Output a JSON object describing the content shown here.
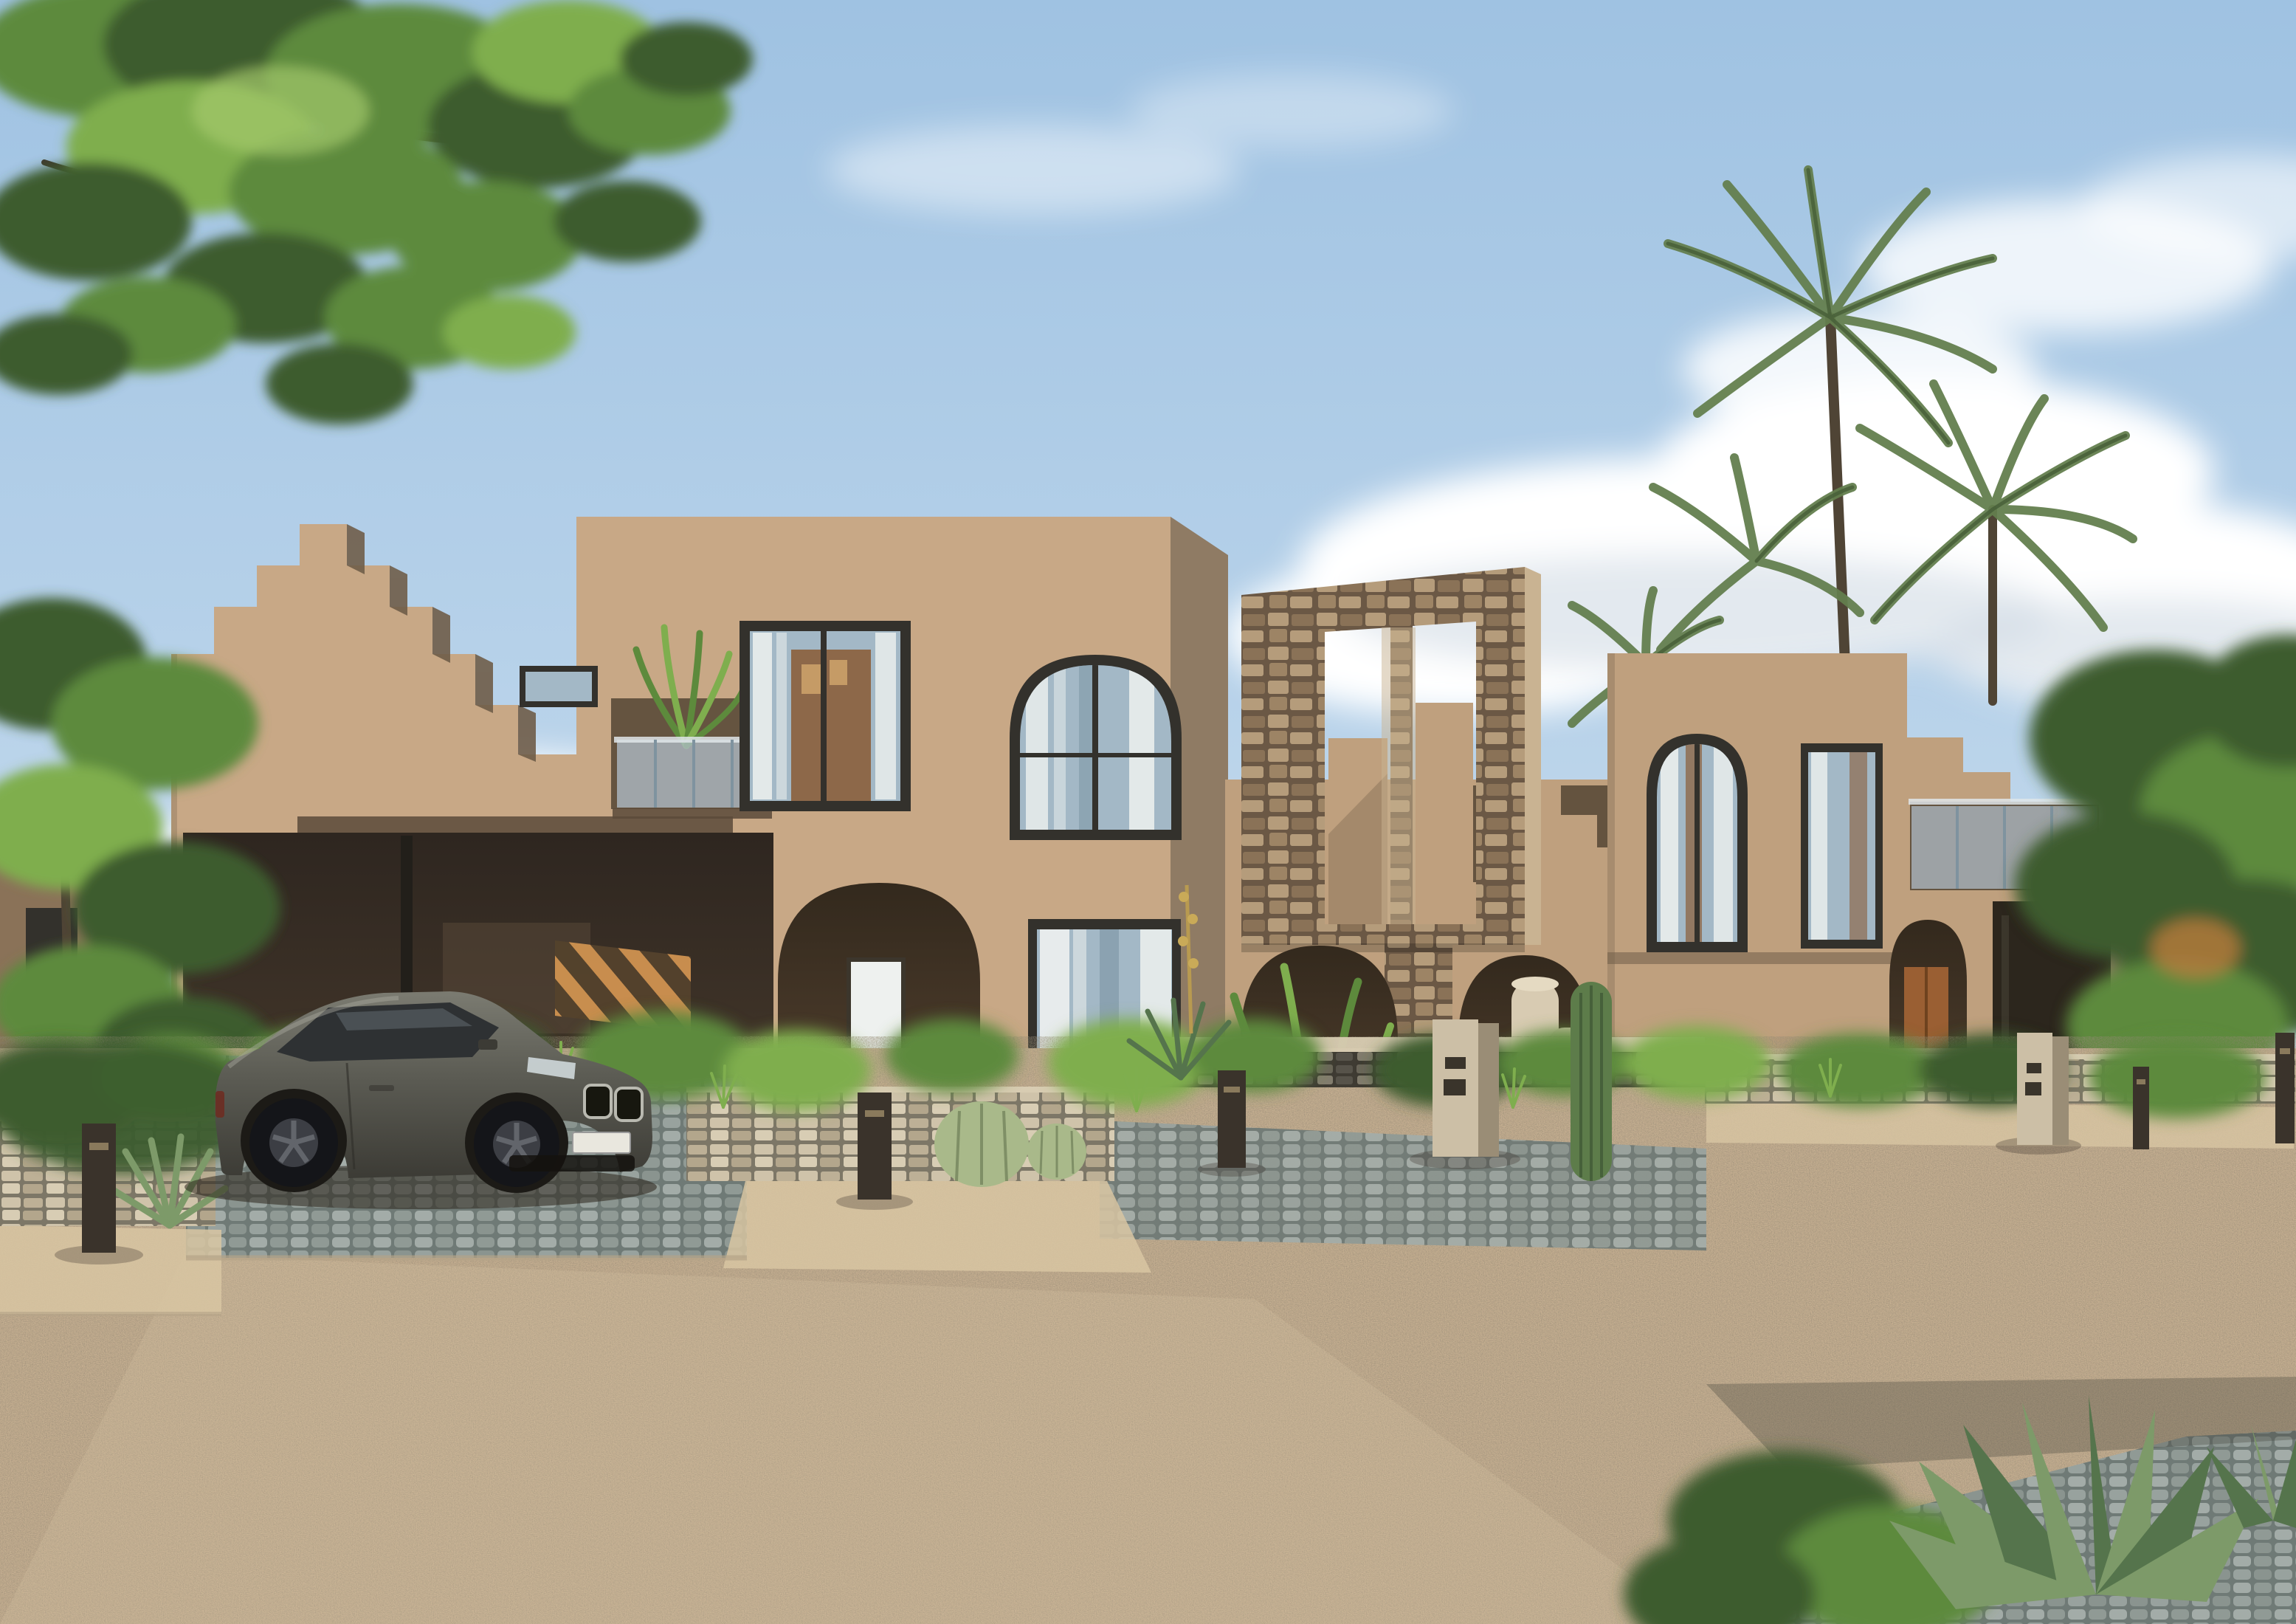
{
  "meta": {
    "description": "Photorealistic architectural rendering: a row of two-storey sand-coloured desert-modern villas with stepped parapets, arched windows and a rough-stone portal frame; palm trees and green trees behind, desert landscaping with agave and cacti in front, a dark grey luxury coupe parked on a cobbled driveway, wide sandy gravel road in the foreground under a blue sky with white clouds."
  },
  "palette": {
    "sky_top": "#9fc2e2",
    "sky_mid": "#b9d3ea",
    "sky_low": "#d8e4ef",
    "cloud": "#ffffff",
    "cloud_shade": "#c8d4e0",
    "wall_sun": "#c8a886",
    "wall_alt": "#bfa07e",
    "wall_side": "#8f7b64",
    "wall_step_shade": "#6f5d49",
    "soffit": "#5a4a39",
    "carport_a": "#2e2620",
    "carport_b": "#4a3c2d",
    "arch_deep": "#33291d",
    "arch_mid": "#4a3a2a",
    "arch_low": "#5f4d3a",
    "frame_dark": "#33312c",
    "glass": "#a3b8c6",
    "glass_dark": "#7e97a6",
    "curtain": "#eef1ef",
    "interior_warm": "#8a5c38",
    "pic_frame": "#c59b66",
    "railing_glass": "#b5c5d1",
    "railing_line": "#7f939f",
    "rail_cap": "#dfe5e9",
    "masonry_bg": "#6b5845",
    "masonry_1": "#b59c7b",
    "masonry_2": "#8a7257",
    "masonry_3": "#9d8465",
    "masonry_edge": "#c9b392",
    "stoneL_bg": "#7d7767",
    "stoneL_1": "#cfc3aa",
    "stoneL_2": "#bdb096",
    "stoneL_3": "#d8cdb4",
    "stoneL_4": "#b3a68c",
    "stone_cap": "#d8ccb2",
    "stoneD_bg": "#3f3b33",
    "stoneD_1": "#6b665a",
    "stoneD_2": "#57534a",
    "stoneD_3": "#837d6e",
    "cobble_bg": "#6f7a76",
    "cobble_1": "#98a29e",
    "cobble_2": "#8a948f",
    "cobble_3": "#a3aca8",
    "cobble_4": "#909a95",
    "curb": "#b5a488",
    "sand": "#c9b293",
    "sand_light": "#dcc9a8",
    "sand_shadow": "#45453a",
    "path_light": "#d8c5a2",
    "green_dark": "#3c5c2e",
    "green_mid": "#5d8a3c",
    "green_light": "#7fae4e",
    "green_hi": "#a4c96b",
    "palm": "#647f4e",
    "palm_dark": "#49613a",
    "trunk": "#4f4435",
    "branch": "#3f3a2e",
    "accent_leaf": "#b97a3c",
    "agave": "#7d9a69",
    "agave_dark": "#55744c",
    "cactus": "#5d7c4a",
    "cactus_light": "#a9b98a",
    "cactus_rib": "#7f8f66",
    "dry_stalk": "#b89a50",
    "car_body_hi": "#7b7b71",
    "car_body": "#5c5c54",
    "car_body_dark": "#3c3b35",
    "car_glass": "#2e3133",
    "car_glass_hi": "#7e8c92",
    "wheel": "#141519",
    "rim": "#3c3e44",
    "spoke": "#62656b",
    "chrome": "#b9b9b0",
    "plate": "#e9e7de",
    "headlight": "#cfd8da",
    "taillight": "#6e2a20",
    "bollard": "#3a332b",
    "bollard_slot": "#8a7a5c",
    "pedestal": "#ccbfa6",
    "pedestal_side": "#9a8d76",
    "slot": "#3a342b",
    "pot": "#d8cbb2",
    "pot_2": "#cfc2a8",
    "pot_rim": "#e5dac2",
    "wood_door": "#9a5f33",
    "pergola_light": "#cf9250",
    "pergola_dark": "#54422c",
    "bg_wall": "#8a7258"
  },
  "scene": {
    "sky": {
      "time_of_day": "day",
      "clouds": "scattered white cumulus"
    },
    "vegetation": [
      "overhanging leafy tree top-left",
      "palm trees behind right villa",
      "green trees far right and far left",
      "desert shrubs and grasses",
      "agave rosettes",
      "barrel cacti",
      "columnar cactus",
      "dry flower stalk"
    ],
    "buildings": {
      "style": "desert-modern stucco with stepped parapets and arches",
      "left_villa": {
        "floors": 2,
        "features": [
          "stepped parapet crown",
          "roof terrace with glass railing and potted plant",
          "small square window",
          "large rectangular picture window",
          "tall arched window",
          "carport with steel post and slatted pergola",
          "entry arch with notice board and bicycle",
          "ground-floor curtained window"
        ]
      },
      "center_section": {
        "features": [
          "freestanding rough-stone portal frame with two tall openings",
          "staircase behind the frame",
          "shaded loggia recess",
          "arch planted with greenery",
          "arch with two cream planter pots",
          "stone pier to ground"
        ]
      },
      "right_villa": {
        "floors": 2,
        "features": [
          "tall arched window",
          "rectangular window",
          "stepped parapet wing",
          "terrace with glass railing",
          "arched entry with wooden door",
          "dark garage opening"
        ]
      }
    },
    "street": {
      "surfaces": [
        "grey cobblestone driveway apron",
        "grey cobblestone street strips",
        "light sand paths",
        "wide sandy gravel foreground"
      ],
      "walls": [
        "light stone low walls",
        "dark stone low wall with light cap"
      ],
      "furniture": {
        "bollard_lights": 5,
        "entry_pedestals": 2
      }
    },
    "vehicle": {
      "type": "luxury coupe",
      "color": "dark grey",
      "position": "parked in front of left villa carport",
      "license_plate": "blank white"
    }
  }
}
